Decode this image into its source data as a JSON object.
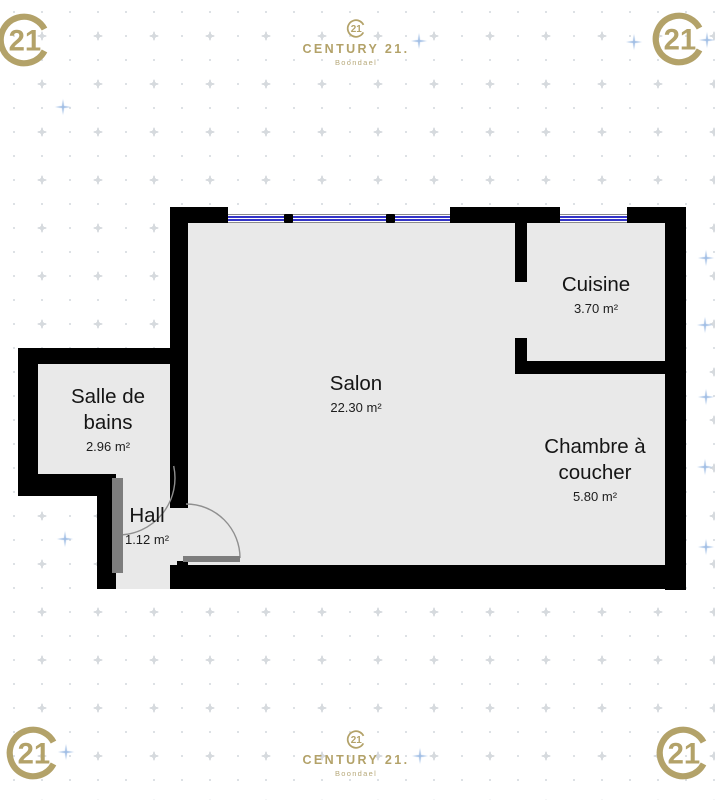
{
  "brand": {
    "seal_text": "21",
    "name": "CENTURY 21.",
    "agency": "Boondael",
    "gold": "#b3a269"
  },
  "rooms": [
    {
      "name": "Salon",
      "area": "22.30 m²"
    },
    {
      "name": "Cuisine",
      "area": "3.70 m²"
    },
    {
      "name": "Chambre à coucher",
      "area": "5.80 m²"
    },
    {
      "name": "Salle de bains",
      "area": "2.96 m²"
    },
    {
      "name": "Hall",
      "area": "1.12 m²"
    }
  ],
  "colors": {
    "wall": "#000000",
    "floor": "#e9e9e9",
    "window_glass": "#3434c8",
    "door_leaf": "#7d7d7d",
    "background": "#ffffff",
    "brand_gold": "#b3a269",
    "sparkle_blue": "#9fbde4"
  }
}
